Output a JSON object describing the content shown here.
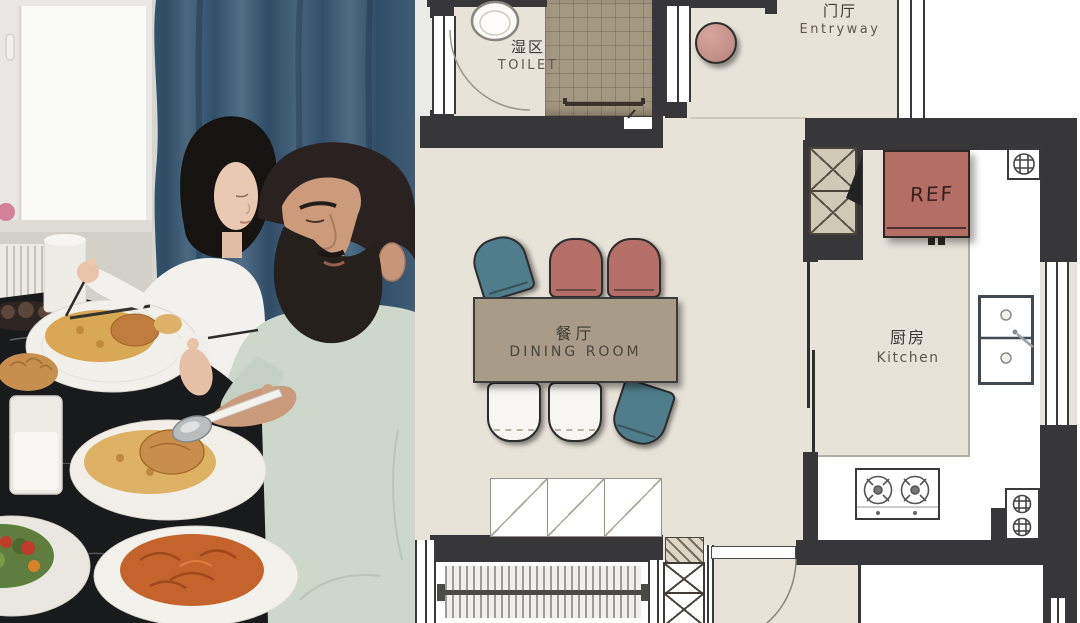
{
  "plan": {
    "rooms": {
      "toilet": {
        "label_zh": "湿区",
        "label_en": "TOILET"
      },
      "entryway": {
        "label_zh": "门厅",
        "label_en": "Entryway"
      },
      "dining": {
        "label_zh": "餐厅",
        "label_en": "DINING ROOM"
      },
      "kitchen": {
        "label_zh": "厨房",
        "label_en": "Kitchen"
      }
    },
    "appliances": {
      "refrigerator_label": "REF"
    },
    "furniture": {
      "dining_chair_colors": [
        "teal",
        "pink",
        "pink",
        "white",
        "white",
        "teal"
      ],
      "entry_stool": "round-stool"
    },
    "colors": {
      "floor": "#e8e3d9",
      "walls": "#37373a",
      "shower_tile": "#a39882",
      "dining_table": "#a89c88",
      "chair_teal": "#4f7d8b",
      "chair_pink": "#b66f68",
      "chair_white": "#f8f6f2",
      "fridge_red": "#b46e66",
      "stool_pink": "#c6938b",
      "counter": "#ffffff"
    }
  },
  "photo": {
    "colors": {
      "curtain_teal": "#3d5a72",
      "window_light": "#fbfbf8",
      "sweater_white": "#f3f1ed",
      "sweater_sage": "#cdd7cc",
      "table_marble": "#191a1c",
      "rice_gold": "#d9a854",
      "pasta_orange": "#c4632c"
    }
  }
}
